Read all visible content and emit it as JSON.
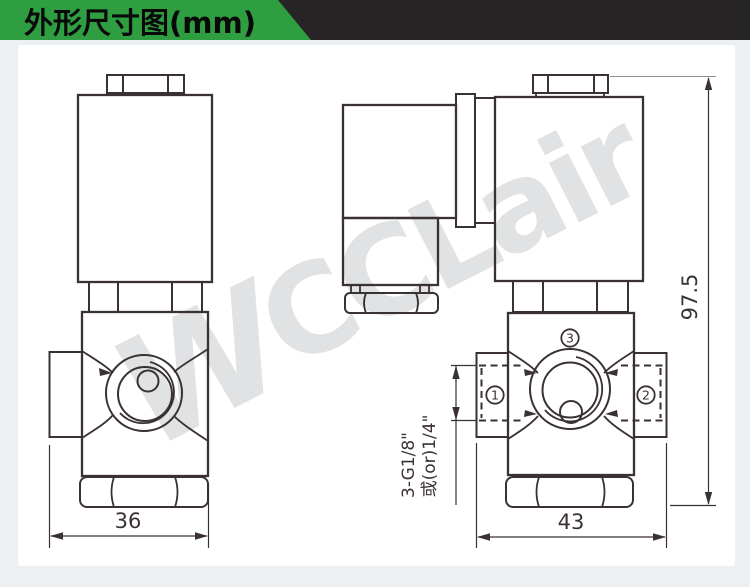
{
  "header": {
    "title": "外形尺寸图(mm)"
  },
  "watermark": {
    "logo": "W",
    "text": "CCLair"
  },
  "front_view": {
    "width": "36"
  },
  "side_view": {
    "width": "43",
    "height": "97.5",
    "thread_line1": "3-G1/8\"",
    "thread_line2": "或(or)1/4\"",
    "ports": [
      "1",
      "2",
      "3"
    ]
  }
}
